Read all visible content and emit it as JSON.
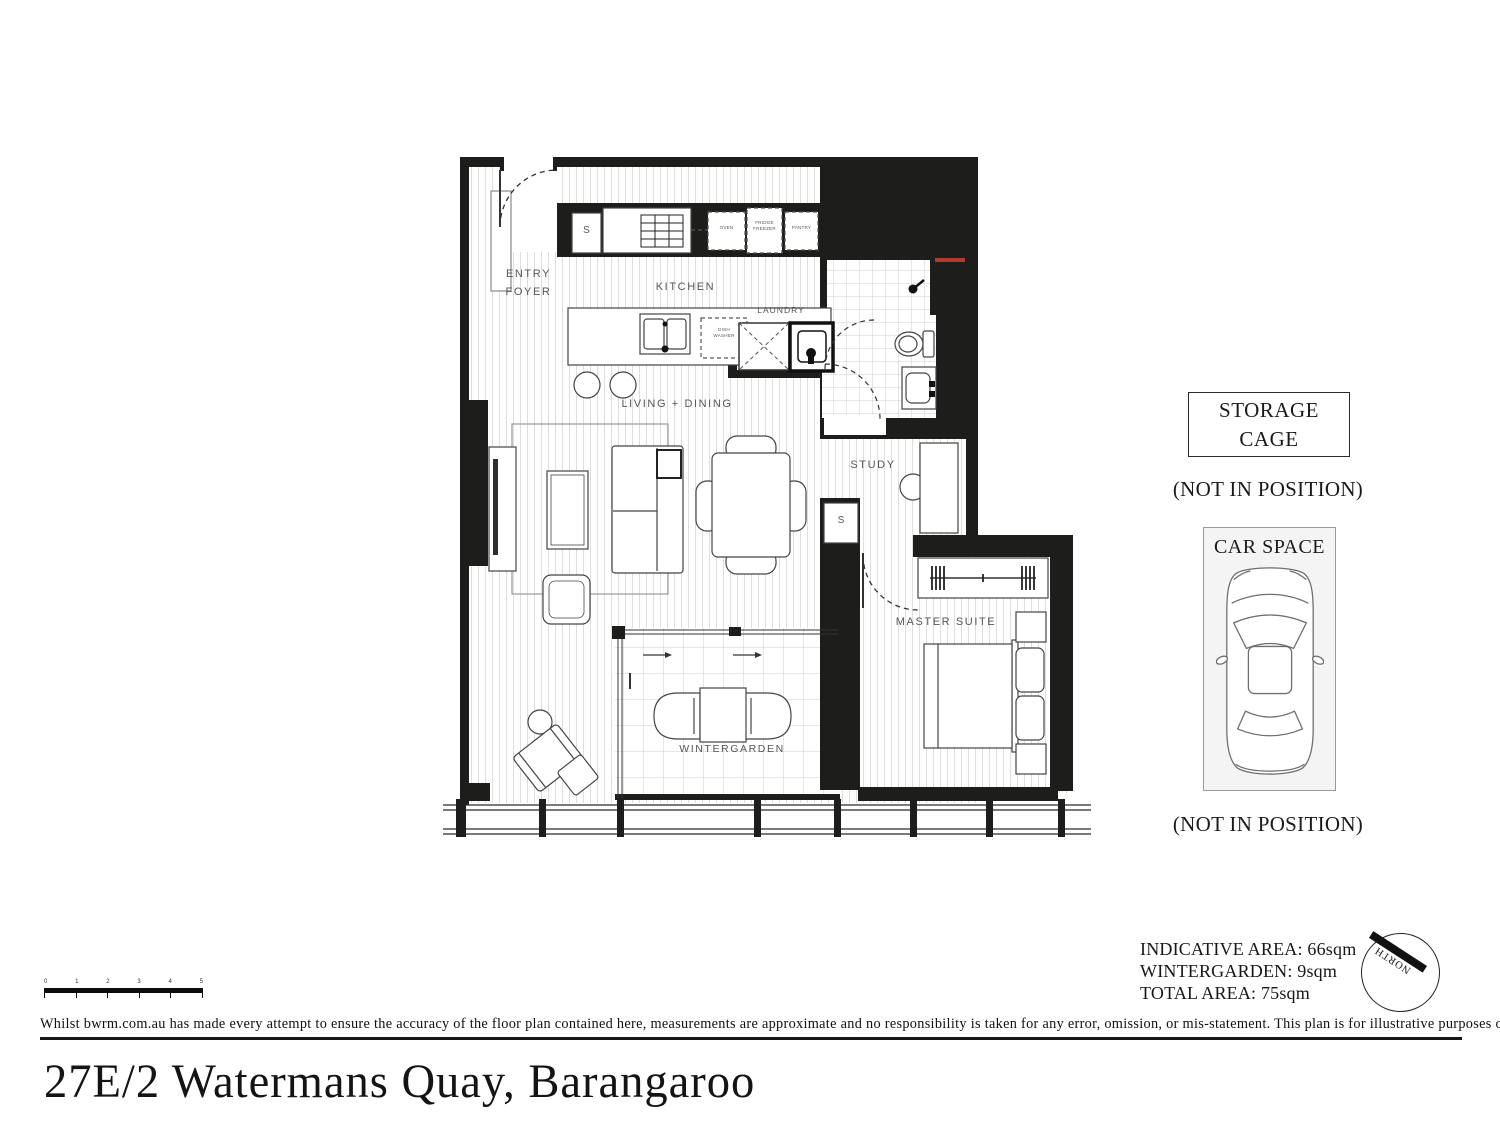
{
  "title": "27E/2 Watermans Quay, Barangaroo",
  "footer": {
    "disclaimer": "Whilst bwrm.com.au has made every attempt to ensure the accuracy of the floor plan contained here, measurements are approximate and no responsibility is taken for any error, omission, or mis-statement. This plan is for illustrative purposes only."
  },
  "plan": {
    "labels": {
      "entry_foyer": "ENTRY\nFOYER",
      "kitchen": "KITCHEN",
      "laundry": "LAUNDRY",
      "living_dining": "LIVING + DINING",
      "study": "STUDY",
      "master_suite": "MASTER SUITE",
      "wintergarden": "WINTERGARDEN",
      "storage_cupboard": "S",
      "oven": "OVEN",
      "fridge": "FRIDGE\nFREEZER",
      "pantry": "PANTRY",
      "dishwasher": "DISH\nWASHER"
    }
  },
  "side_panel": {
    "storage_cage_label": "STORAGE\nCAGE",
    "storage_cage_note": "(NOT IN POSITION)",
    "car_space_label": "CAR SPACE",
    "car_space_note": "(NOT IN POSITION)"
  },
  "areas": {
    "indicative": "INDICATIVE AREA: 66sqm",
    "wintergarden": "WINTERGARDEN: 9sqm",
    "total": "TOTAL AREA: 75sqm"
  },
  "compass": {
    "label": "NORTH"
  },
  "scale_bar": {
    "ticks": [
      "0",
      "1",
      "2",
      "3",
      "4",
      "5"
    ]
  },
  "colors": {
    "wall": "#1d1d1b",
    "red_mark": "#b23a2e",
    "floor_line": "#dedede",
    "tile_line": "#cfcfcf",
    "label_text": "#565656",
    "car_space_bg": "#f4f4f4"
  }
}
